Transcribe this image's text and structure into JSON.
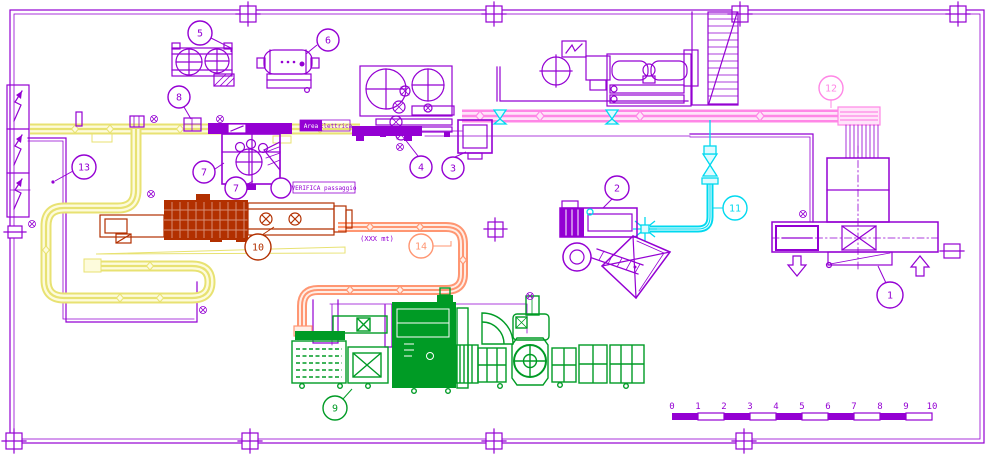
{
  "colors": {
    "purple": "#9400D3",
    "red": "#B23000",
    "green": "#009B25",
    "yellow": "#E8E272",
    "yellowPale": "#FDFBDC",
    "pink": "#FF87E6",
    "pinkPale": "#FFE4F9",
    "cyan": "#00D9EF",
    "cyanPale": "#DFFBFF",
    "orange": "#FF9672",
    "orangePale": "#FFEDE5"
  },
  "drawing": {
    "balloons": {
      "b1": "1",
      "b2": "2",
      "b3": "3",
      "b4": "4",
      "b5": "5",
      "b6": "6",
      "b7a": "7",
      "b7b": "7",
      "b8": "8",
      "b9": "9",
      "b10": "10",
      "b11": "11",
      "b12": "12",
      "b13": "13",
      "b14": "14"
    },
    "notes": {
      "area_left": "Area",
      "area_right": "Elettrica",
      "verifica": "VERIFICA passaggio",
      "distance": "(XXX mt)"
    },
    "scalebar": {
      "t0": "0",
      "t1": "1",
      "t2": "2",
      "t3": "3",
      "t4": "4",
      "t5": "5",
      "t6": "6",
      "t7": "7",
      "t8": "8",
      "t9": "9",
      "t10": "10"
    }
  }
}
